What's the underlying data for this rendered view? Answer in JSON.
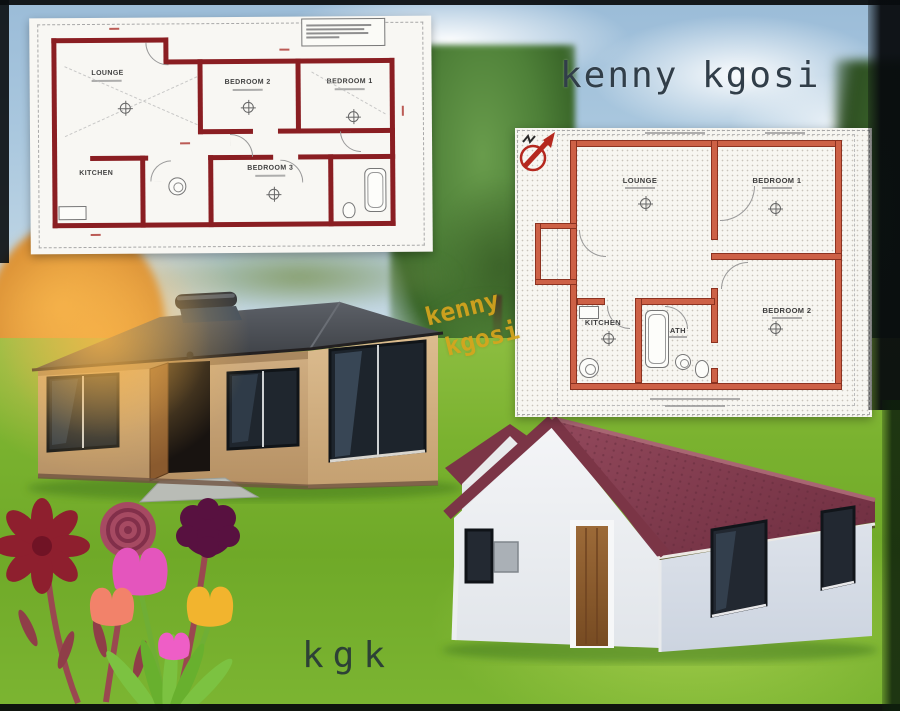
{
  "texts": {
    "title": "kenny kgosi",
    "watermark_line1": "kenny",
    "watermark_line2": "kgosi",
    "signature": "kgk"
  },
  "floorplan_left": {
    "rooms": [
      {
        "label": "LOUNGE"
      },
      {
        "label": "BEDROOM 2"
      },
      {
        "label": "BEDROOM 1"
      },
      {
        "label": "KITCHEN"
      },
      {
        "label": "BEDROOM 3"
      }
    ]
  },
  "floorplan_right": {
    "rooms": [
      {
        "label": "LOUNGE"
      },
      {
        "label": "BEDROOM 1"
      },
      {
        "label": "KITCHEN"
      },
      {
        "label": "BATH"
      },
      {
        "label": "BEDROOM 2"
      }
    ]
  },
  "colors": {
    "plan_wall_left": "#8a1e22",
    "plan_wall_right": "#cd6146",
    "roof_left_house": "#46494e",
    "roof_right_house": "#7b3546",
    "wall_left_house": "#c9a87e",
    "wall_right_house": "#eef0f3",
    "grass": "#79b22f",
    "sky": "#a9c7de",
    "title_text": "#313e49",
    "watermark_text": "#d7a51d",
    "signature_text": "#2d4136"
  }
}
